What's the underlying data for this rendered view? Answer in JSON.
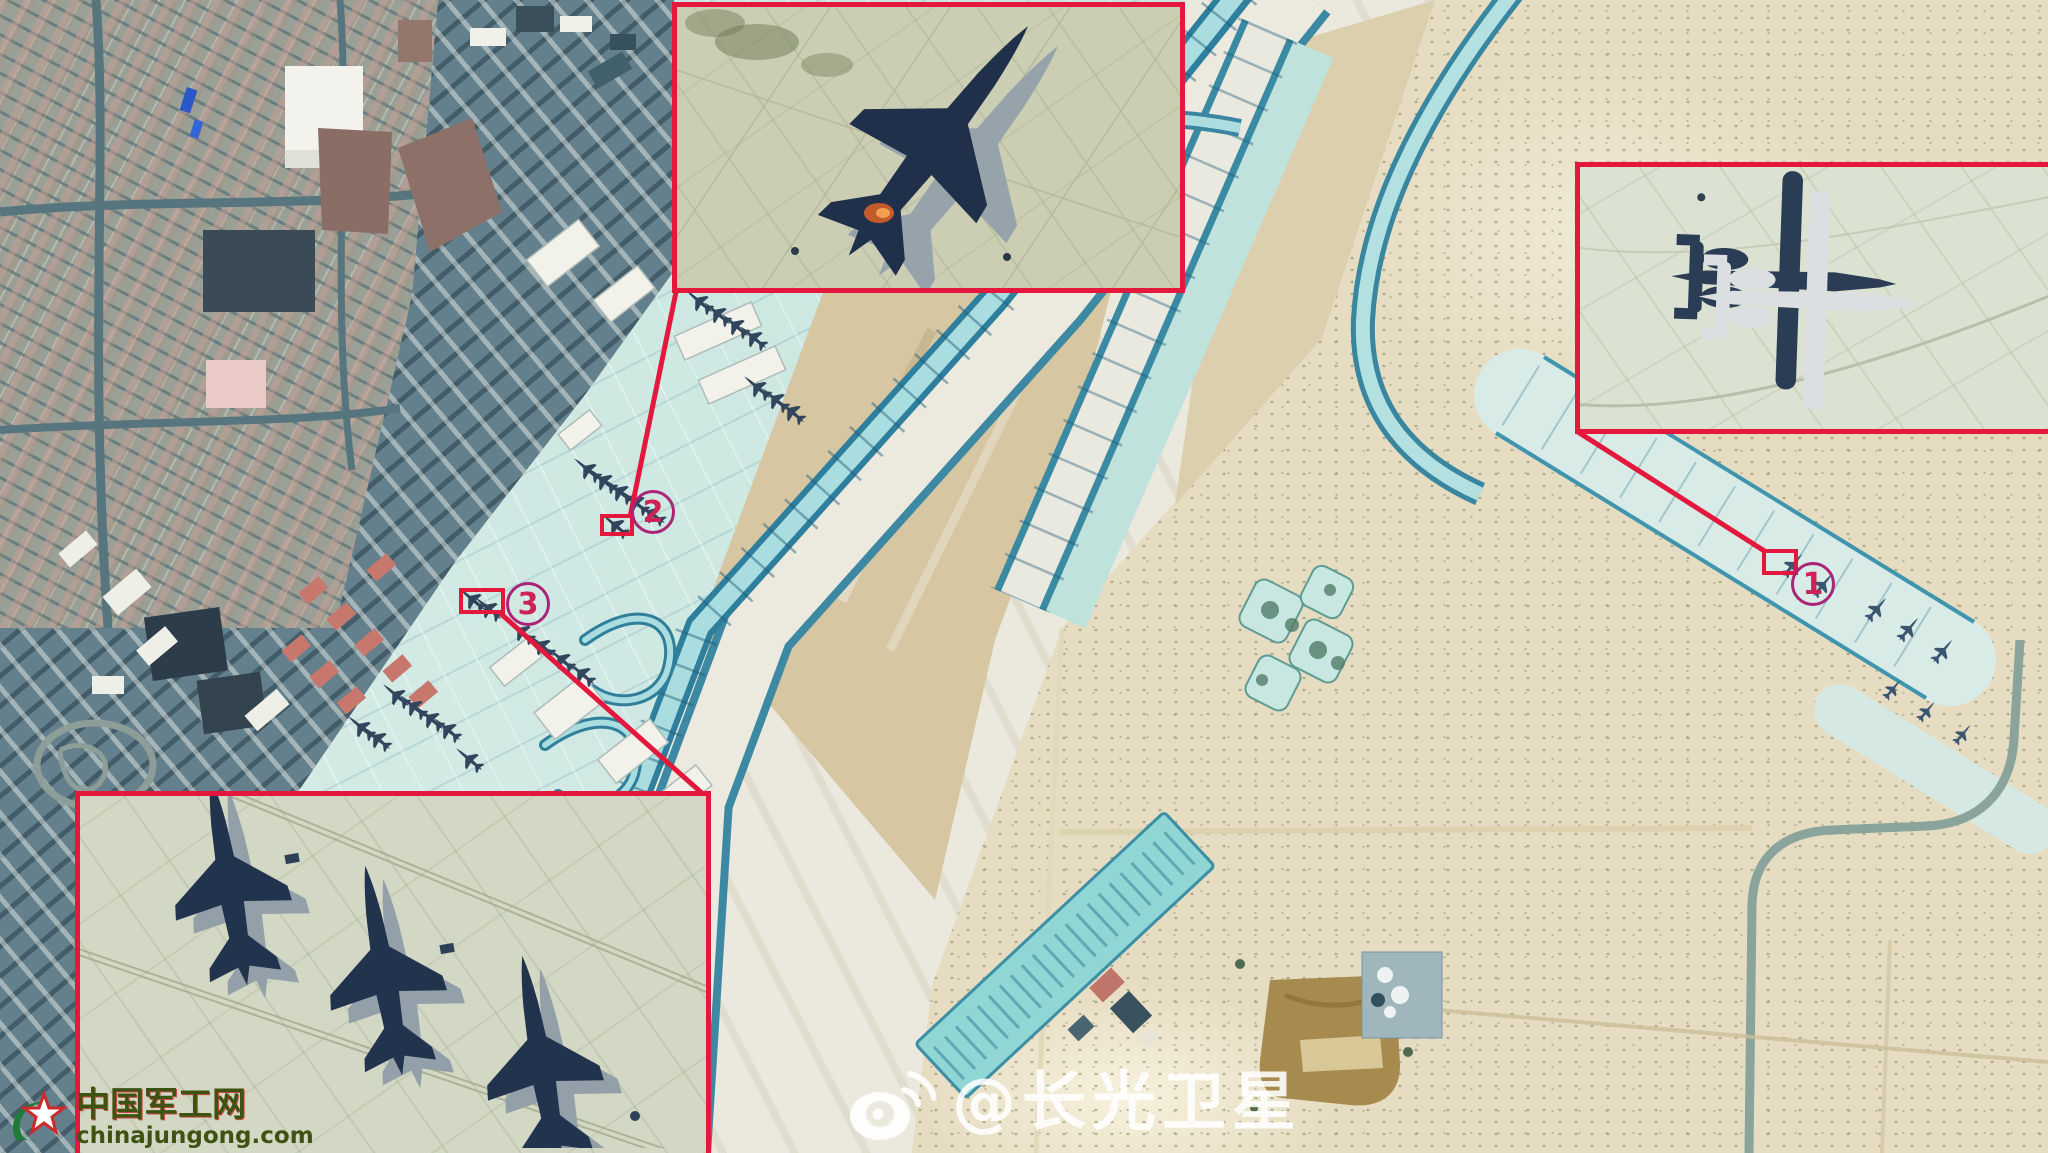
{
  "watermark": {
    "icon": "weibo-icon",
    "handle": "@长光卫星"
  },
  "site_logo": {
    "icon": "star-swoosh-icon",
    "name": "中国军工网",
    "url": "chinajungong.com"
  },
  "annotations": {
    "accent_color": "#e4173c",
    "circle_color": "#aa2478",
    "digit_color": "#ce2156",
    "markers": [
      {
        "label": "1"
      },
      {
        "label": "2"
      },
      {
        "label": "3"
      }
    ],
    "insets": [
      {
        "id": "inset-top",
        "subject": "f15-fighter-jet-closeup"
      },
      {
        "id": "inset-right",
        "subject": "a10-attack-aircraft-closeup"
      },
      {
        "id": "inset-bottom",
        "subject": "three-fighter-jets-closeup"
      }
    ]
  },
  "scene": {
    "type": "satellite-photo-airbase",
    "colors": {
      "apron_cyan": "#c9e6e0",
      "taxiway_edge": "#2e7f9d",
      "runway_pale": "#eceadf",
      "infield_tan": "#d6c6a2",
      "desert": "#e6dcc2",
      "urban": "#9aa096"
    }
  }
}
